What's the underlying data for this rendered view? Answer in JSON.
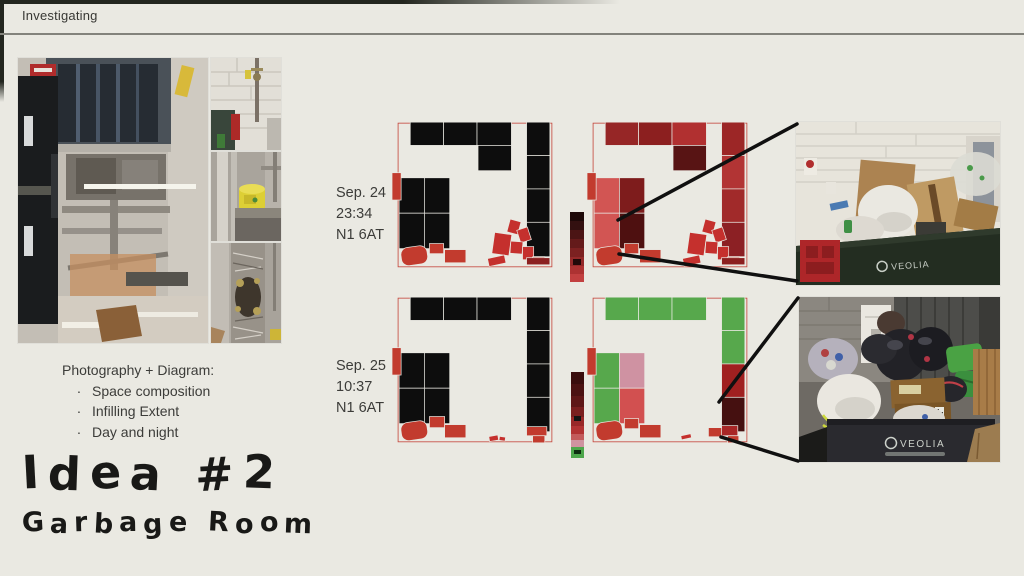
{
  "header": {
    "title": "Investigating"
  },
  "left_panel": {
    "caption_title": "Photography + Diagram:",
    "bullet_char": "·",
    "bullets": [
      "Space composition",
      "Infilling Extent",
      "Day and night"
    ],
    "idea_title": "Idea #2",
    "idea_subtitle": "Garbage Room"
  },
  "rows": [
    {
      "date": "Sep. 24",
      "time": "23:34",
      "postcode": "N1 6AT"
    },
    {
      "date": "Sep. 25",
      "time": "10:37",
      "postcode": "N1 6AT"
    }
  ],
  "photos": {
    "bin_brand": "VEOLIA"
  },
  "palette": {
    "background": "#eae9e2",
    "outline_red": "#c4453a",
    "accent_red": "#c23b2e",
    "black_cell": "#0d0d0d",
    "green_cell": "#57a84c",
    "callout_black": "#101010"
  },
  "diagrams": {
    "sep24_objects": {
      "outline": [
        8,
        5,
        152,
        142
      ],
      "cells": [
        [
          20,
          4,
          33,
          23,
          "#0d0d0d"
        ],
        [
          53,
          4,
          33,
          23,
          "#0d0d0d"
        ],
        [
          86,
          4,
          34,
          23,
          "#0d0d0d"
        ],
        [
          87,
          27,
          33,
          25,
          "#0d0d0d"
        ],
        [
          135,
          4,
          23,
          33,
          "#0d0d0d"
        ],
        [
          135,
          37,
          23,
          33,
          "#0d0d0d"
        ],
        [
          135,
          70,
          23,
          33,
          "#0d0d0d"
        ],
        [
          135,
          103,
          23,
          34,
          "#0d0d0d"
        ],
        [
          9,
          59,
          25,
          35,
          "#0d0d0d"
        ],
        [
          34,
          59,
          25,
          35,
          "#0d0d0d"
        ],
        [
          9,
          94,
          25,
          35,
          "#0d0d0d"
        ],
        [
          34,
          94,
          25,
          35,
          "#0d0d0d"
        ],
        [
          2,
          54,
          9,
          27,
          "#c23b2e"
        ],
        [
          11,
          127,
          26,
          18,
          "#c23b2e",
          -8,
          7
        ],
        [
          39,
          124,
          14,
          10,
          "#c23b2e"
        ],
        [
          54,
          130,
          21,
          13,
          "#c23b2e"
        ],
        [
          117,
          101,
          11,
          13,
          "#c5302d",
          15
        ],
        [
          127,
          109,
          11,
          13,
          "#c5302d",
          -18
        ],
        [
          102,
          114,
          17,
          21,
          "#c5302d",
          8
        ],
        [
          119,
          122,
          12,
          12,
          "#c5302d",
          4
        ],
        [
          97,
          137,
          17,
          8,
          "#c5302d",
          -12
        ],
        [
          131,
          127,
          11,
          13,
          "#c5302d"
        ],
        [
          141,
          137,
          12,
          8,
          "#c23b2e"
        ],
        [
          135,
          138,
          23,
          7,
          "#8c2020"
        ]
      ]
    },
    "sep24_extent": {
      "outline": [
        8,
        5,
        152,
        142
      ],
      "cells": [
        [
          20,
          4,
          33,
          23,
          "#962626"
        ],
        [
          53,
          4,
          33,
          23,
          "#8c1f1f"
        ],
        [
          86,
          4,
          34,
          23,
          "#b13030"
        ],
        [
          87,
          27,
          33,
          25,
          "#581414"
        ],
        [
          135,
          4,
          23,
          33,
          "#9c2626"
        ],
        [
          135,
          37,
          23,
          33,
          "#b23434"
        ],
        [
          135,
          70,
          23,
          33,
          "#a12a2a"
        ],
        [
          135,
          103,
          23,
          34,
          "#8c2024"
        ],
        [
          9,
          59,
          25,
          35,
          "#d25553"
        ],
        [
          34,
          59,
          25,
          35,
          "#7e1c1c"
        ],
        [
          9,
          94,
          25,
          35,
          "#d25553"
        ],
        [
          34,
          94,
          25,
          35,
          "#4e1010"
        ],
        [
          2,
          54,
          9,
          27,
          "#c23b2e"
        ],
        [
          11,
          127,
          26,
          18,
          "#c23b2e",
          -8,
          7
        ],
        [
          39,
          124,
          14,
          10,
          "#c23b2e"
        ],
        [
          54,
          130,
          21,
          13,
          "#c23b2e"
        ],
        [
          117,
          101,
          11,
          13,
          "#c5302d",
          15
        ],
        [
          127,
          109,
          11,
          13,
          "#c5302d",
          -18
        ],
        [
          102,
          114,
          17,
          21,
          "#c5302d",
          8
        ],
        [
          119,
          122,
          12,
          12,
          "#c5302d",
          4
        ],
        [
          97,
          137,
          17,
          8,
          "#c5302d",
          -12
        ],
        [
          131,
          127,
          11,
          13,
          "#c5302d"
        ],
        [
          141,
          137,
          12,
          8,
          "#c23b2e"
        ],
        [
          135,
          138,
          23,
          7,
          "#8c1f1f"
        ]
      ]
    },
    "sep25_objects": {
      "outline": [
        8,
        5,
        152,
        142
      ],
      "cells": [
        [
          20,
          4,
          33,
          23,
          "#0d0d0d"
        ],
        [
          53,
          4,
          33,
          23,
          "#0d0d0d"
        ],
        [
          86,
          4,
          34,
          23,
          "#0d0d0d"
        ],
        [
          135,
          4,
          23,
          33,
          "#0d0d0d"
        ],
        [
          135,
          37,
          23,
          33,
          "#0d0d0d"
        ],
        [
          135,
          70,
          23,
          33,
          "#0d0d0d"
        ],
        [
          135,
          103,
          23,
          34,
          "#0d0d0d"
        ],
        [
          9,
          59,
          25,
          35,
          "#0d0d0d"
        ],
        [
          34,
          59,
          25,
          35,
          "#0d0d0d"
        ],
        [
          9,
          94,
          25,
          35,
          "#0d0d0d"
        ],
        [
          34,
          94,
          25,
          35,
          "#0d0d0d"
        ],
        [
          2,
          54,
          9,
          27,
          "#c23b2e"
        ],
        [
          11,
          127,
          26,
          18,
          "#c23b2e",
          -8,
          7
        ],
        [
          39,
          122,
          15,
          11,
          "#c23b2e"
        ],
        [
          54,
          130,
          21,
          13,
          "#c23b2e"
        ],
        [
          135,
          132,
          20,
          9,
          "#c23b2e"
        ],
        [
          141,
          141,
          12,
          7,
          "#c23b2e"
        ],
        [
          98,
          141,
          9,
          5,
          "#c5302d",
          -10
        ],
        [
          108,
          142,
          6,
          4,
          "#c5302d",
          8
        ]
      ]
    },
    "sep25_extent": {
      "outline": [
        8,
        5,
        152,
        142
      ],
      "cells": [
        [
          20,
          4,
          33,
          23,
          "#57a84c"
        ],
        [
          53,
          4,
          33,
          23,
          "#57a84c"
        ],
        [
          86,
          4,
          34,
          23,
          "#57a84c"
        ],
        [
          135,
          4,
          23,
          33,
          "#57a84c"
        ],
        [
          135,
          37,
          23,
          33,
          "#57a84c"
        ],
        [
          135,
          70,
          23,
          33,
          "#a02020"
        ],
        [
          135,
          103,
          23,
          34,
          "#451010"
        ],
        [
          9,
          59,
          25,
          35,
          "#57a84c"
        ],
        [
          34,
          59,
          25,
          35,
          "#cf92a2"
        ],
        [
          9,
          94,
          25,
          35,
          "#57a84c"
        ],
        [
          34,
          94,
          25,
          35,
          "#d25050"
        ],
        [
          2,
          54,
          9,
          27,
          "#c23b2e"
        ],
        [
          11,
          127,
          26,
          18,
          "#c23b2e",
          -8,
          7
        ],
        [
          39,
          124,
          14,
          10,
          "#c23b2e"
        ],
        [
          54,
          130,
          21,
          13,
          "#c23b2e"
        ],
        [
          122,
          133,
          14,
          9,
          "#c23b2e"
        ],
        [
          135,
          131,
          16,
          10,
          "#a82626"
        ],
        [
          141,
          141,
          11,
          7,
          "#c23b2e"
        ],
        [
          95,
          140,
          10,
          4,
          "#c5302d",
          -12
        ]
      ]
    }
  },
  "strips": {
    "sep24_chute": {
      "bands": [
        [
          9,
          "#1d0808"
        ],
        [
          9,
          "#331010"
        ],
        [
          9,
          "#4b1414"
        ],
        [
          9,
          "#641a1a"
        ],
        [
          9,
          "#7c2121"
        ],
        [
          9,
          "#942929"
        ],
        [
          8,
          "#ad3232"
        ],
        [
          8,
          "#c24040"
        ]
      ],
      "marks": [
        [
          47,
          6,
          "#230909"
        ]
      ]
    },
    "sep25_chute": {
      "bands": [
        [
          12,
          "#3a0d0d"
        ],
        [
          12,
          "#4b1212"
        ],
        [
          11,
          "#5e1717"
        ],
        [
          10,
          "#7a1f1f"
        ],
        [
          9,
          "#992828"
        ],
        [
          8,
          "#b23333"
        ],
        [
          6,
          "#c35b5b"
        ],
        [
          7,
          "#cf93a0"
        ],
        [
          11,
          "#4da64b"
        ]
      ],
      "marks": [
        [
          44,
          5,
          "#141414"
        ],
        [
          78,
          4,
          "#0e2e10"
        ]
      ]
    }
  },
  "callouts": {
    "lines": [
      [
        618,
        220,
        797,
        124
      ],
      [
        619,
        254,
        797,
        281
      ],
      [
        719,
        402,
        798,
        298
      ],
      [
        721,
        437,
        798,
        461
      ]
    ]
  }
}
